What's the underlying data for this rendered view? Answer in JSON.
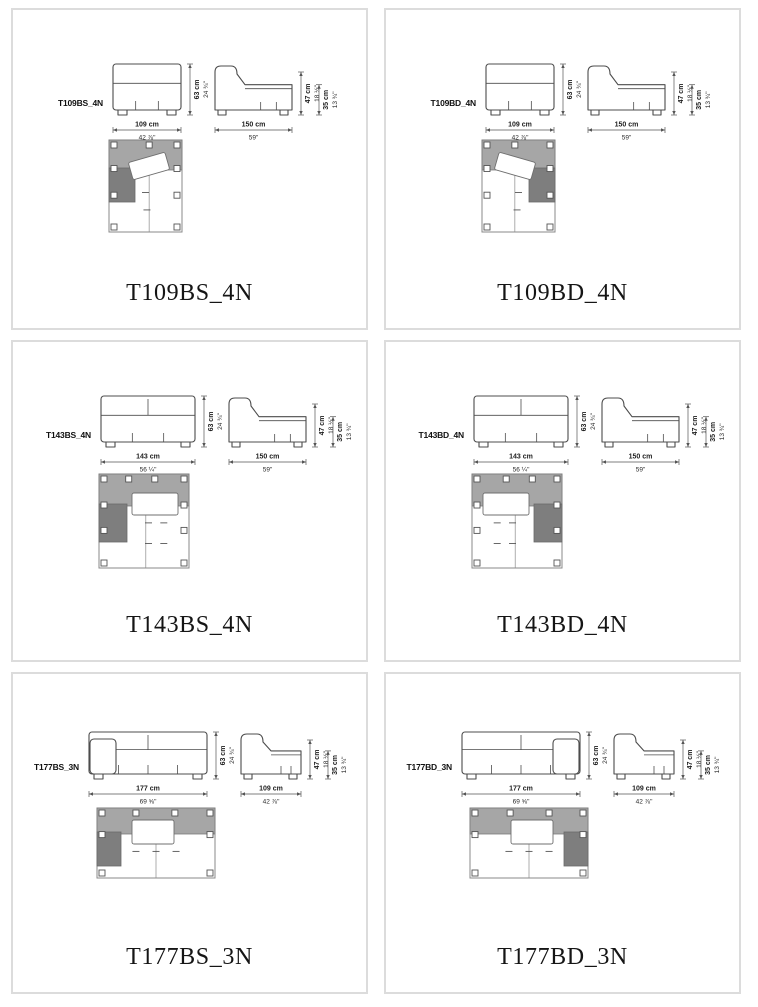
{
  "page": {
    "background": "#ffffff",
    "cell_border_color": "#dcdcdc"
  },
  "colors": {
    "drawing_line": "#4c4c4c",
    "dimension_text": "#1d1d1d",
    "plan_light_gray": "#a6a6a6",
    "plan_dark_gray": "#7e7e7e"
  },
  "cells": [
    {
      "code": "T109BS_4N",
      "caption": "T109BS_4N",
      "front": {
        "width_cm": "109 cm",
        "width_in": "42 ⅞\"",
        "height_cm": "63 cm",
        "height_in": "24 ¾\""
      },
      "side": {
        "depth_cm": "150 cm",
        "depth_in": "59\"",
        "h1_cm": "47 cm",
        "h1_in": "18 ½\"",
        "h2_cm": "35 cm",
        "h2_in": "13 ¾\""
      }
    },
    {
      "code": "T109BD_4N",
      "caption": "T109BD_4N",
      "front": {
        "width_cm": "109 cm",
        "width_in": "42 ⅞\"",
        "height_cm": "63 cm",
        "height_in": "24 ¾\""
      },
      "side": {
        "depth_cm": "150 cm",
        "depth_in": "59\"",
        "h1_cm": "47 cm",
        "h1_in": "18 ½\"",
        "h2_cm": "35 cm",
        "h2_in": "13 ¾\""
      }
    },
    {
      "code": "T143BS_4N",
      "caption": "T143BS_4N",
      "front": {
        "width_cm": "143 cm",
        "width_in": "56 ¼\"",
        "height_cm": "63 cm",
        "height_in": "24 ¾\""
      },
      "side": {
        "depth_cm": "150 cm",
        "depth_in": "59\"",
        "h1_cm": "47 cm",
        "h1_in": "18 ½\"",
        "h2_cm": "35 cm",
        "h2_in": "13 ¾\""
      }
    },
    {
      "code": "T143BD_4N",
      "caption": "T143BD_4N",
      "front": {
        "width_cm": "143 cm",
        "width_in": "56 ¼\"",
        "height_cm": "63 cm",
        "height_in": "24 ¾\""
      },
      "side": {
        "depth_cm": "150 cm",
        "depth_in": "59\"",
        "h1_cm": "47 cm",
        "h1_in": "18 ½\"",
        "h2_cm": "35 cm",
        "h2_in": "13 ¾\""
      }
    },
    {
      "code": "T177BS_3N",
      "caption": "T177BS_3N",
      "front": {
        "width_cm": "177 cm",
        "width_in": "69 ⅝\"",
        "height_cm": "63 cm",
        "height_in": "24 ¾\""
      },
      "side": {
        "depth_cm": "109 cm",
        "depth_in": "42 ⅞\"",
        "h1_cm": "47 cm",
        "h1_in": "18 ½\"",
        "h2_cm": "35 cm",
        "h2_in": "13 ¾\""
      }
    },
    {
      "code": "T177BD_3N",
      "caption": "T177BD_3N",
      "front": {
        "width_cm": "177 cm",
        "width_in": "69 ⅝\"",
        "height_cm": "63 cm",
        "height_in": "24 ¾\""
      },
      "side": {
        "depth_cm": "109 cm",
        "depth_in": "42 ⅞\"",
        "h1_cm": "47 cm",
        "h1_in": "18 ½\"",
        "h2_cm": "35 cm",
        "h2_in": "13 ¾\""
      }
    }
  ]
}
